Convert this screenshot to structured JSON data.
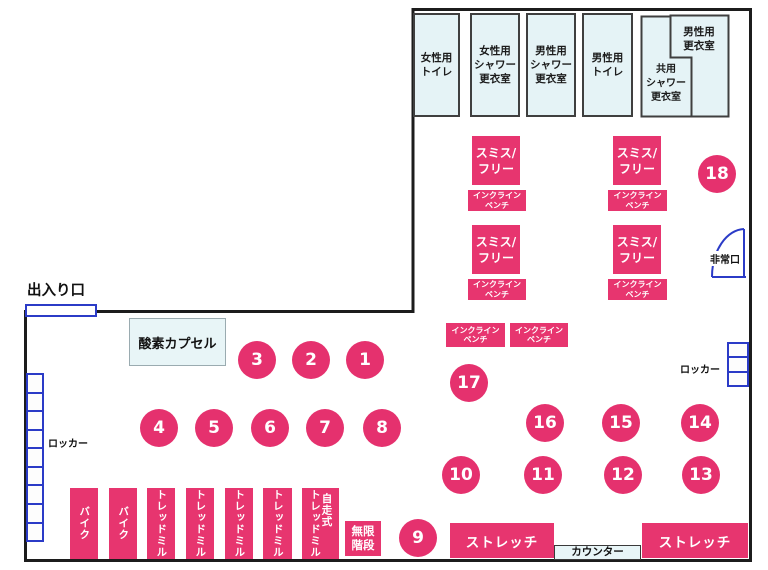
{
  "colors": {
    "pink": "#E7356F",
    "room_fill": "#E5F3F6",
    "locker_door_blue": "#2B3BC7",
    "wall_black": "#1C1C1C"
  },
  "entrance": {
    "label": "出入り口"
  },
  "emergency_exit": {
    "label": "非常口"
  },
  "lockers": {
    "left_label": "ロッカー",
    "right_label": "ロッカー"
  },
  "oxygen_capsule": {
    "label": "酸素カプセル"
  },
  "counter": {
    "label": "カウンター"
  },
  "stretch": {
    "label": "ストレッチ"
  },
  "infinite_stairs": {
    "line1": "無限",
    "line2": "階段"
  },
  "smith_free": {
    "line1": "スミス/",
    "line2": "フリー"
  },
  "incline_bench": {
    "line1": "インクライン",
    "line2": "ベンチ"
  },
  "rooms": [
    {
      "id": "womens-toilet",
      "lines": [
        "女性用",
        "トイレ"
      ]
    },
    {
      "id": "womens-shower-locker",
      "lines": [
        "女性用",
        "シャワー",
        "更衣室"
      ]
    },
    {
      "id": "mens-shower-locker",
      "lines": [
        "男性用",
        "シャワー",
        "更衣室"
      ]
    },
    {
      "id": "mens-toilet",
      "lines": [
        "男性用",
        "トイレ"
      ]
    },
    {
      "id": "shared-shower-locker",
      "lines": [
        "共用",
        "シャワー",
        "更衣室"
      ]
    },
    {
      "id": "mens-locker-room",
      "lines": [
        "男性用",
        "更衣室"
      ]
    }
  ],
  "machines": {
    "labels": [
      "バイク",
      "バイク",
      "トレッドミル",
      "トレッドミル",
      "トレッドミル",
      "トレッドミル"
    ],
    "self_propelled": {
      "main": "トレッドミル",
      "sub": "自走式"
    }
  },
  "circle_numbers": [
    "1",
    "2",
    "3",
    "4",
    "5",
    "6",
    "7",
    "8",
    "9",
    "10",
    "11",
    "12",
    "13",
    "14",
    "15",
    "16",
    "17",
    "18"
  ]
}
